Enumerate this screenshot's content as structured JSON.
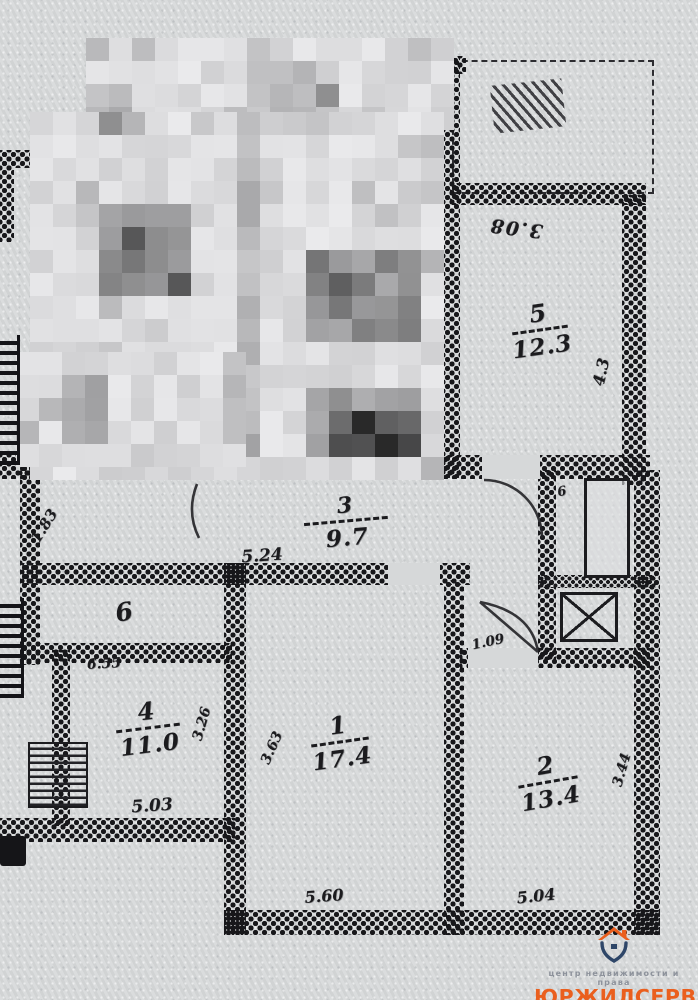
{
  "paper": {
    "bg": "#d6d8d9",
    "ink": "#1b1b1e"
  },
  "rooms": {
    "room1": {
      "number": "1",
      "area": "17.4"
    },
    "room2": {
      "number": "2",
      "area": "13.4"
    },
    "room3": {
      "number": "3",
      "area": "9.7"
    },
    "room4": {
      "number": "4",
      "area": "11.0"
    },
    "room5": {
      "number": "5",
      "area": "12.3"
    },
    "room6": {
      "number": "6"
    }
  },
  "dims": {
    "d308": {
      "text": "3.08"
    },
    "d43": {
      "text": "4.3"
    },
    "d183": {
      "text": "1.83"
    },
    "d524": {
      "text": "5.24"
    },
    "d655": {
      "text": "6.55"
    },
    "d326": {
      "text": "3.26"
    },
    "d503": {
      "text": "5.03"
    },
    "d363": {
      "text": "3.63"
    },
    "d560": {
      "text": "5.60"
    },
    "d344": {
      "text": "3.44"
    },
    "d504": {
      "text": "5.04"
    },
    "d109": {
      "text": "1.09"
    },
    "shaft": {
      "text": "6"
    }
  },
  "logo": {
    "tagline": "центр недвижимости и права",
    "name": "ЮРЖИЛСЕРВИС",
    "accent": "#ea5f1e",
    "navy": "#2e4668",
    "gray": "#8d929b"
  }
}
